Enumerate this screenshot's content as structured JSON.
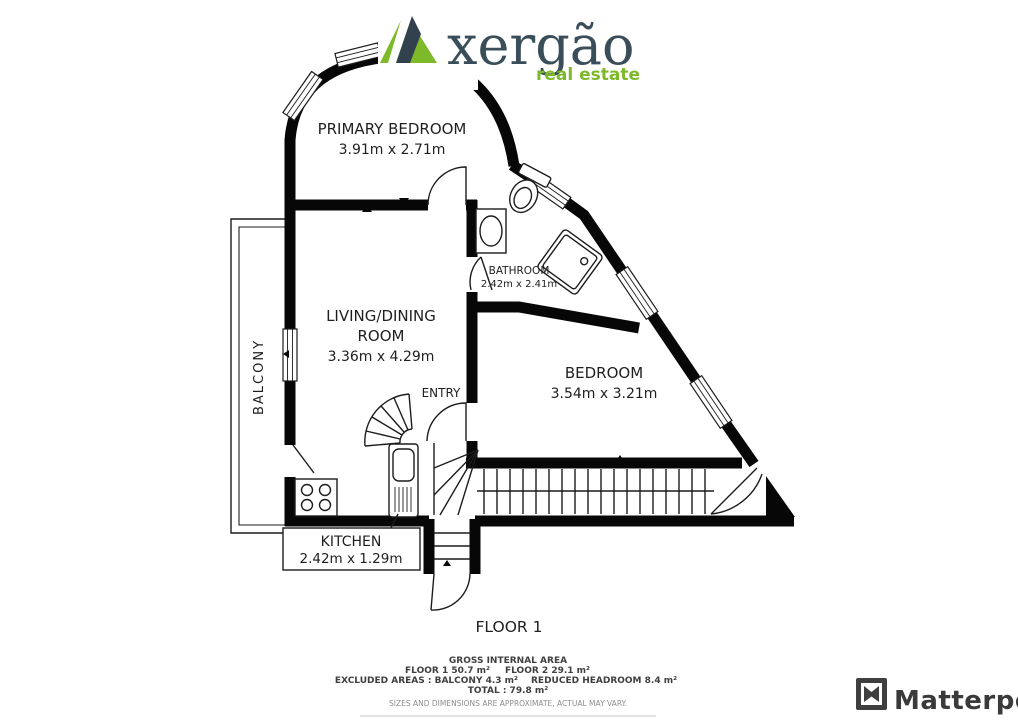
{
  "brand": {
    "name": "xergão",
    "tagline": "real estate",
    "green": "#7db929",
    "navy": "#3a4e5a"
  },
  "plan": {
    "rooms": {
      "primary_bedroom": {
        "label": "PRIMARY BEDROOM",
        "dims": "3.91m x 2.71m"
      },
      "living_dining": {
        "line1": "LIVING/DINING",
        "line2": "ROOM",
        "dims": "3.36m x 4.29m"
      },
      "bathroom": {
        "label": "BATHROOM",
        "dims": "2.42m x 2.41m"
      },
      "bedroom": {
        "label": "BEDROOM",
        "dims": "3.54m x 3.21m"
      },
      "kitchen": {
        "label": "KITCHEN",
        "dims": "2.42m x 1.29m"
      },
      "balcony": {
        "label": "BALCONY"
      },
      "entry": {
        "label": "ENTRY"
      }
    },
    "floor_label": "FLOOR 1"
  },
  "footer": {
    "title": "GROSS INTERNAL AREA",
    "floor1_area": "FLOOR 1 50.7 m²",
    "floor2_area": "FLOOR 2 29.1 m²",
    "excluded": "EXCLUDED AREAS :  BALCONY 4.3 m²",
    "reduced": "REDUCED HEADROOM 8.4 m²",
    "total": "TOTAL :  79.8 m²",
    "disclaimer": "SIZES AND DIMENSIONS ARE APPROXIMATE, ACTUAL MAY VARY."
  },
  "watermark": {
    "label": "Matterport"
  }
}
